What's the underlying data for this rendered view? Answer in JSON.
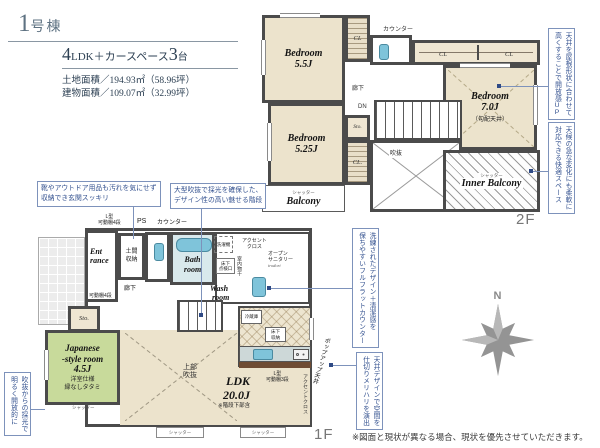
{
  "colors": {
    "accent_blue": "#33518f",
    "wall_gray": "#4b4b4b",
    "room_beige": "#ece3cc",
    "tatami_green": "#c8da9b",
    "water_blue": "#7fc4da",
    "header_navy": "#2e4154",
    "compass_gray": "#949494"
  },
  "header": {
    "building_no_num": "1",
    "building_no_suffix": "号棟",
    "layout_num1": "4",
    "layout_text1": "LDK＋カースペース",
    "layout_num2": "3",
    "layout_text2": "台",
    "land_area": "土地面積／194.93㎡（58.96坪）",
    "building_area": "建物面積／109.07㎡（32.99坪）"
  },
  "floor2": {
    "label": "2F",
    "bedroom1": {
      "name": "Bedroom",
      "size": "5.5J"
    },
    "bedroom2": {
      "name": "Bedroom",
      "size": "5.25J"
    },
    "bedroom3": {
      "name": "Bedroom",
      "size": "7.0J",
      "note": "（勾配天井）"
    },
    "cl1": "CL",
    "cl2": "CL",
    "cl3": "CL",
    "cl4": "CL.",
    "sto": "Sto.",
    "counter": "カウンター",
    "hall": "廊下",
    "dn": "DN",
    "void": "吹抜",
    "balcony": {
      "shutter": "シャッター",
      "name": "Balcony"
    },
    "inner_balcony": {
      "shutter": "シャッター",
      "name": "Inner Balcony"
    }
  },
  "floor1": {
    "label": "1F",
    "entrance": {
      "line1": "Ent",
      "line2": "rance"
    },
    "doma": {
      "line1": "土間",
      "line2": "収納"
    },
    "shelf_l4": {
      "line1": "L型",
      "line2": "可動棚4段"
    },
    "ps": "PS",
    "counter": "カウンター",
    "bath": {
      "line1": "Bath",
      "line2": "room"
    },
    "washer": "洗濯機",
    "accent_cloth": {
      "line1": "アクセント",
      "line2": "クロス"
    },
    "wash": {
      "line1": "Wash",
      "line2": "room"
    },
    "hatch_door": {
      "line1": "床下",
      "line2": "点検口"
    },
    "indoor_drying": "室内物干",
    "open_sanitary": {
      "line1": "オープン",
      "line2": "サニタリー",
      "line3": "irodori"
    },
    "hall": "廊下",
    "shelf4": "可動棚4段",
    "sto": "Sto.",
    "japanese": {
      "name1": "Japanese",
      "name2": "-style room",
      "size": "4.5J",
      "note1": "洋室仕様",
      "note2": "縁なしタタミ"
    },
    "upper_void": {
      "line1": "上部",
      "line2": "吹抜"
    },
    "ldk": {
      "name": "LDK",
      "size": "20.0J",
      "note": "※階段下部含"
    },
    "fridge": "冷蔵庫",
    "underfloor_storage": {
      "line1": "床下",
      "line2": "収納"
    },
    "shelf_l3": {
      "line1": "L型",
      "line2": "可動棚3段"
    },
    "accent_cloth_v": "アクセントクロス",
    "popup_ceiling": "ポップアップ天井",
    "shutter1": "シャッター",
    "shutter2": "シャッター",
    "shutter3": "シャッター"
  },
  "callouts": {
    "shoes": {
      "line1": "靴やアウトドア用品も汚れを気にせず",
      "line2": "収納でき玄関スッキリ"
    },
    "stairs": {
      "line1": "大型吹抜で採光を確保した、",
      "line2": "デザイン性の高い魅せる階段"
    },
    "ceiling_up": {
      "col1": "天井を屋根形状に合わせて",
      "col2": "高くすることで開放感UP"
    },
    "weather": {
      "col1": "天候の急な変化にも柔軟に",
      "col2": "対応できる快適スペース"
    },
    "flat_counter": {
      "col1": "洗練されたデザイン＋清潔感を",
      "col2": "保ちやすいフルフラットカウンター"
    },
    "ceiling_design": {
      "col1": "天井デザインで空間を",
      "col2": "仕切りメリハリを演出"
    },
    "void_light": {
      "col1": "吹抜からの採光で",
      "col2": "明るく開放的に"
    }
  },
  "compass": {
    "north": "N"
  },
  "footer": {
    "disclaimer": "※図面と現状が異なる場合、現状を優先させていただきます。"
  }
}
